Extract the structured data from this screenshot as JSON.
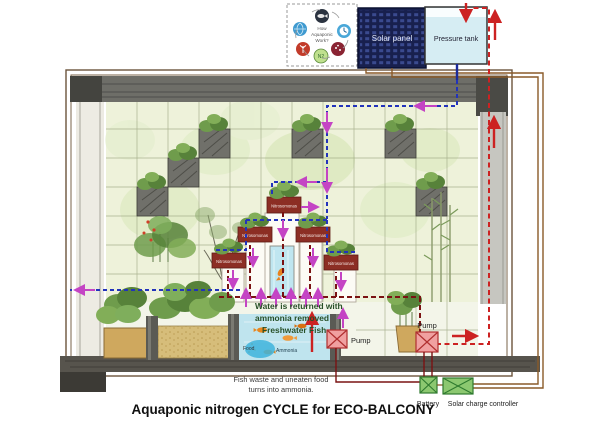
{
  "title": "Aquaponic nitrogen CYCLE for ECO-BALCONY",
  "top": {
    "badge_line1": "How",
    "badge_line2": "Aquaponic",
    "badge_line3": "Work?",
    "solar_panel_label": "Solar panel",
    "pressure_tank_label": "Pressure tank"
  },
  "biofilter": {
    "label": "Nitrosomonas",
    "box_count": 5
  },
  "tank": {
    "return_line1": "Water is returned with",
    "return_line2": "ammonia removed",
    "fish_label": "Freshwater Fish",
    "food_label": "Food",
    "ammonia_label": "Ammonia"
  },
  "pumps": {
    "pump1": "Pump",
    "pump2": "Pump"
  },
  "power": {
    "battery": "Battery",
    "controller": "Solar charge controller"
  },
  "footnote": {
    "line1": "Fish waste and uneaten food",
    "line2": "turns into ammonia."
  },
  "colors": {
    "clean_water_flow": "#2233bb",
    "ammonia_flow": "#7a1212",
    "pressure_flow": "#cc2222",
    "flow_arrow": "#c444c4",
    "wire": "#8a5a28",
    "solar_panel": "#18204e",
    "tank_water": "#bfe4ee",
    "bacteria_box": "#8c2e24",
    "power_box": "#8cc870",
    "wall_tile": "#eef2da"
  }
}
